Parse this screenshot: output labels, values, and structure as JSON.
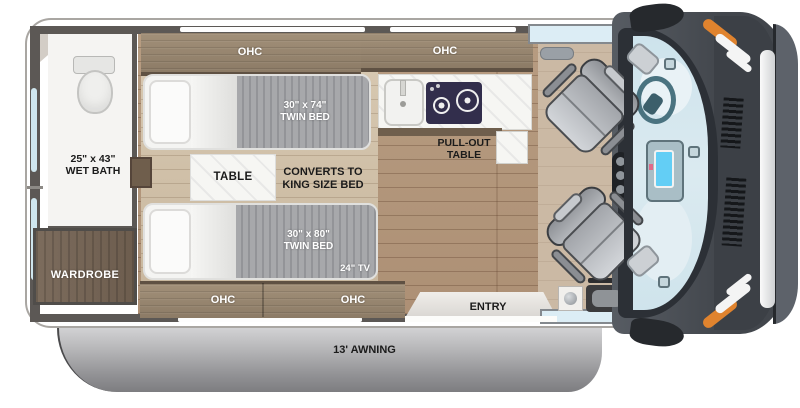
{
  "floorplan": {
    "wet_bath": {
      "line1": "25\" x 43\"",
      "line2": "WET BATH"
    },
    "wardrobe": "WARDROBE",
    "ohc_labels": [
      "OHC",
      "OHC",
      "OHC",
      "OHC"
    ],
    "twin_bed_top": {
      "line1": "30\" x 74\"",
      "line2": "TWIN BED"
    },
    "twin_bed_bottom": {
      "line1": "30\" x 80\"",
      "line2": "TWIN BED"
    },
    "table": "TABLE",
    "converts": {
      "line1": "CONVERTS TO",
      "line2": "KING SIZE BED"
    },
    "tv": "24\" TV",
    "pull_out_table": {
      "line1": "PULL-OUT",
      "line2": "TABLE"
    },
    "entry": "ENTRY",
    "awning": "13' AWNING"
  },
  "colors": {
    "cabinet_wood": "#95846f",
    "wardrobe_wood": "#75655a",
    "floor_wood": "#b79c81",
    "wall": "#5c5855",
    "blanket_gray": "#a3a4a7",
    "awning_gray": "#a9a9ab",
    "windshield_glass": "#cfe4ec",
    "accent_orange": "#e0832e",
    "stove_navy": "#322e4c"
  }
}
